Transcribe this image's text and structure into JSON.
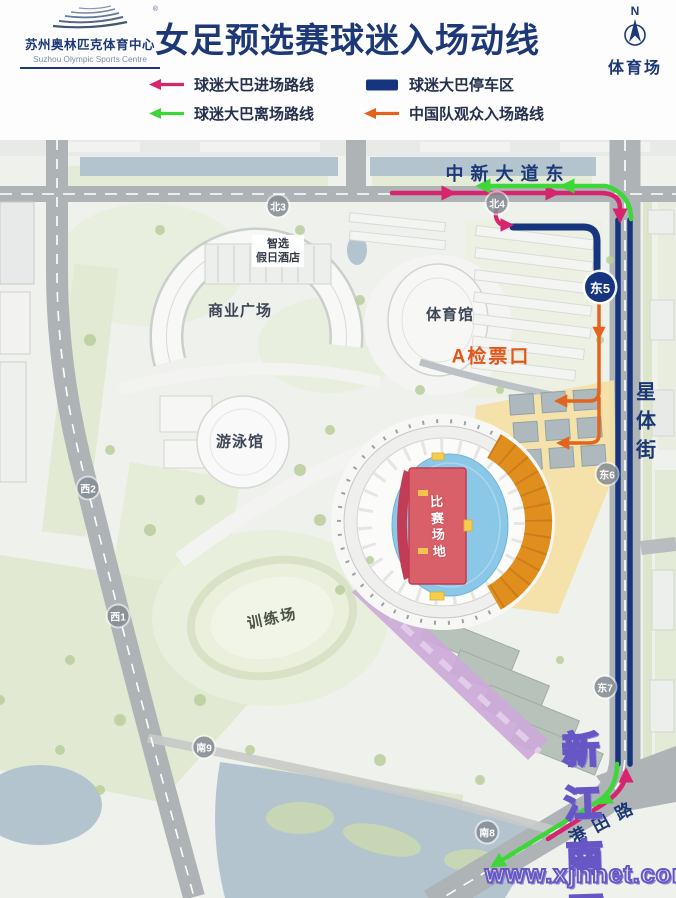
{
  "header": {
    "logo": {
      "swoosh_icon": "stadium-swoosh-arcs",
      "registered_mark": "®",
      "name_cn": "苏州奥林匹克体育中心",
      "name_en": "Suzhou Olympic Sports Centre"
    },
    "title": "女足预选赛球迷入场动线",
    "compass": {
      "north_label": "N",
      "place_label": "体育场"
    }
  },
  "legend": {
    "items": [
      {
        "label": "球迷大巴进场路线",
        "icon": "arrow-left",
        "color": "#d6246e"
      },
      {
        "label": "球迷大巴停车区",
        "icon": "rect",
        "color": "#17357f"
      },
      {
        "label": "球迷大巴离场路线",
        "icon": "arrow-left",
        "color": "#3fd63a"
      },
      {
        "label": "中国队观众入场路线",
        "icon": "arrow-left",
        "color": "#e2641e"
      }
    ]
  },
  "map": {
    "road_labels": {
      "north_road": "中新大道东",
      "east_road": "星体街",
      "southeast_road": "港田路"
    },
    "places": {
      "commercial_plaza": "商业广场",
      "gymnasium": "体育馆",
      "swimming_hall": "游泳馆",
      "training_field": "训练场",
      "hotel_line1": "智选",
      "hotel_line2": "假日酒店",
      "match_field": "比赛场地",
      "ticket_gate_a": "A检票口"
    },
    "gates": {
      "north3": "北3",
      "north4": "北4",
      "east5": "东5",
      "east6": "东6",
      "east7": "东7",
      "west1": "西1",
      "west2": "西2",
      "south8": "南8",
      "south9": "南9"
    },
    "route_colors": {
      "fan_bus_enter": "#d6246e",
      "fan_bus_exit": "#3fd63a",
      "bus_parking": "#17357f",
      "china_fans_enter": "#e2641e"
    }
  },
  "watermark": {
    "site_name": "新江南网",
    "site_url": "www.xjnnet.com"
  }
}
